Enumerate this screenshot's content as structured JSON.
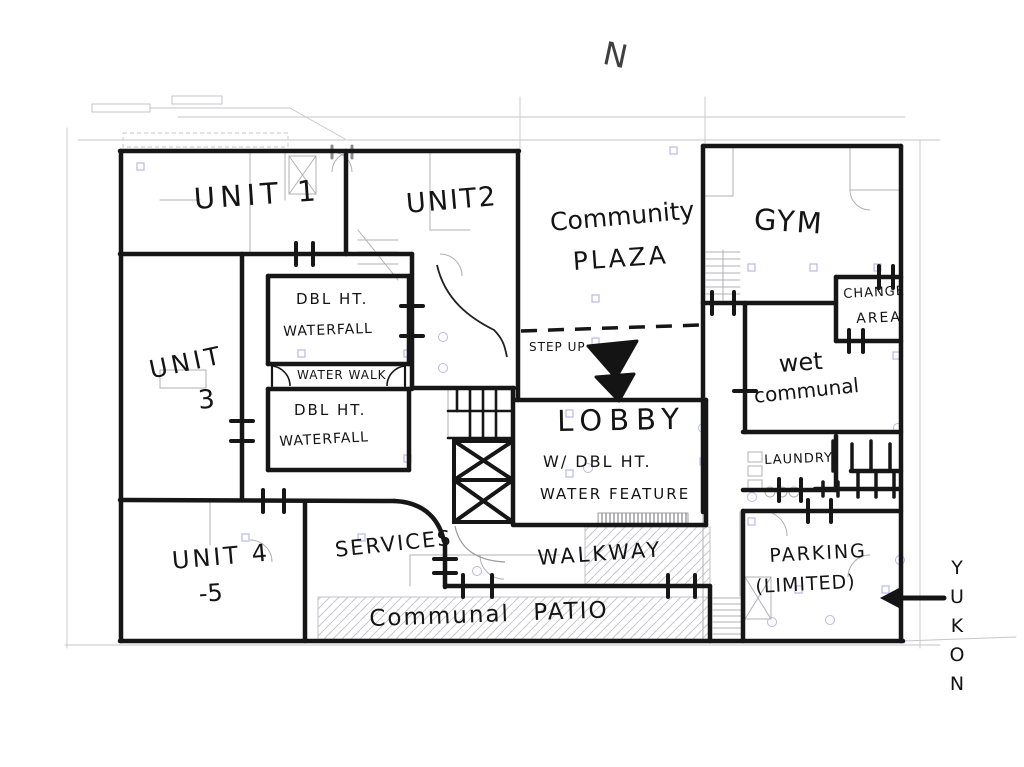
{
  "page": {
    "paper_color": "#ffffff",
    "ink_color": "#161616",
    "cad_line_color": "#b0b0b6",
    "cad_marker_color": "#b9b9e8",
    "hatch_color": "#c7c7cc"
  },
  "compass": {
    "label": "N"
  },
  "rooms": {
    "unit1": "UNIT 1",
    "unit2": "UNIT2",
    "community_plaza": {
      "line1": "Community",
      "line2": "PLAZA"
    },
    "gym": "GYM",
    "change_area": {
      "line1": "CHANGE",
      "line2": "AREA"
    },
    "unit3": {
      "line1": "UNIT",
      "line2": "3"
    },
    "waterfall_upper": {
      "line1": "DBL HT.",
      "line2": "WATERFALL"
    },
    "water_walk": "WATER WALK",
    "waterfall_lower": {
      "line1": "DBL HT.",
      "line2": "WATERFALL"
    },
    "step_up": "STEP UP",
    "lobby": {
      "line1": "LOBBY",
      "line2": "W/ DBL HT.",
      "line3": "WATER FEATURE"
    },
    "wet_communal": {
      "line1": "wet",
      "line2": "communal"
    },
    "laundry": "LAUNDRY,",
    "unit45": {
      "line1": "UNIT 4",
      "line2": "-5"
    },
    "services": "SERVICES",
    "walkway": "WALKWAY",
    "communal_patio": {
      "line1": "Communal",
      "line2": "PATIO"
    },
    "parking": {
      "line1": "PARKING",
      "line2": "(LIMITED)"
    }
  },
  "street": {
    "name": "YUKON"
  }
}
